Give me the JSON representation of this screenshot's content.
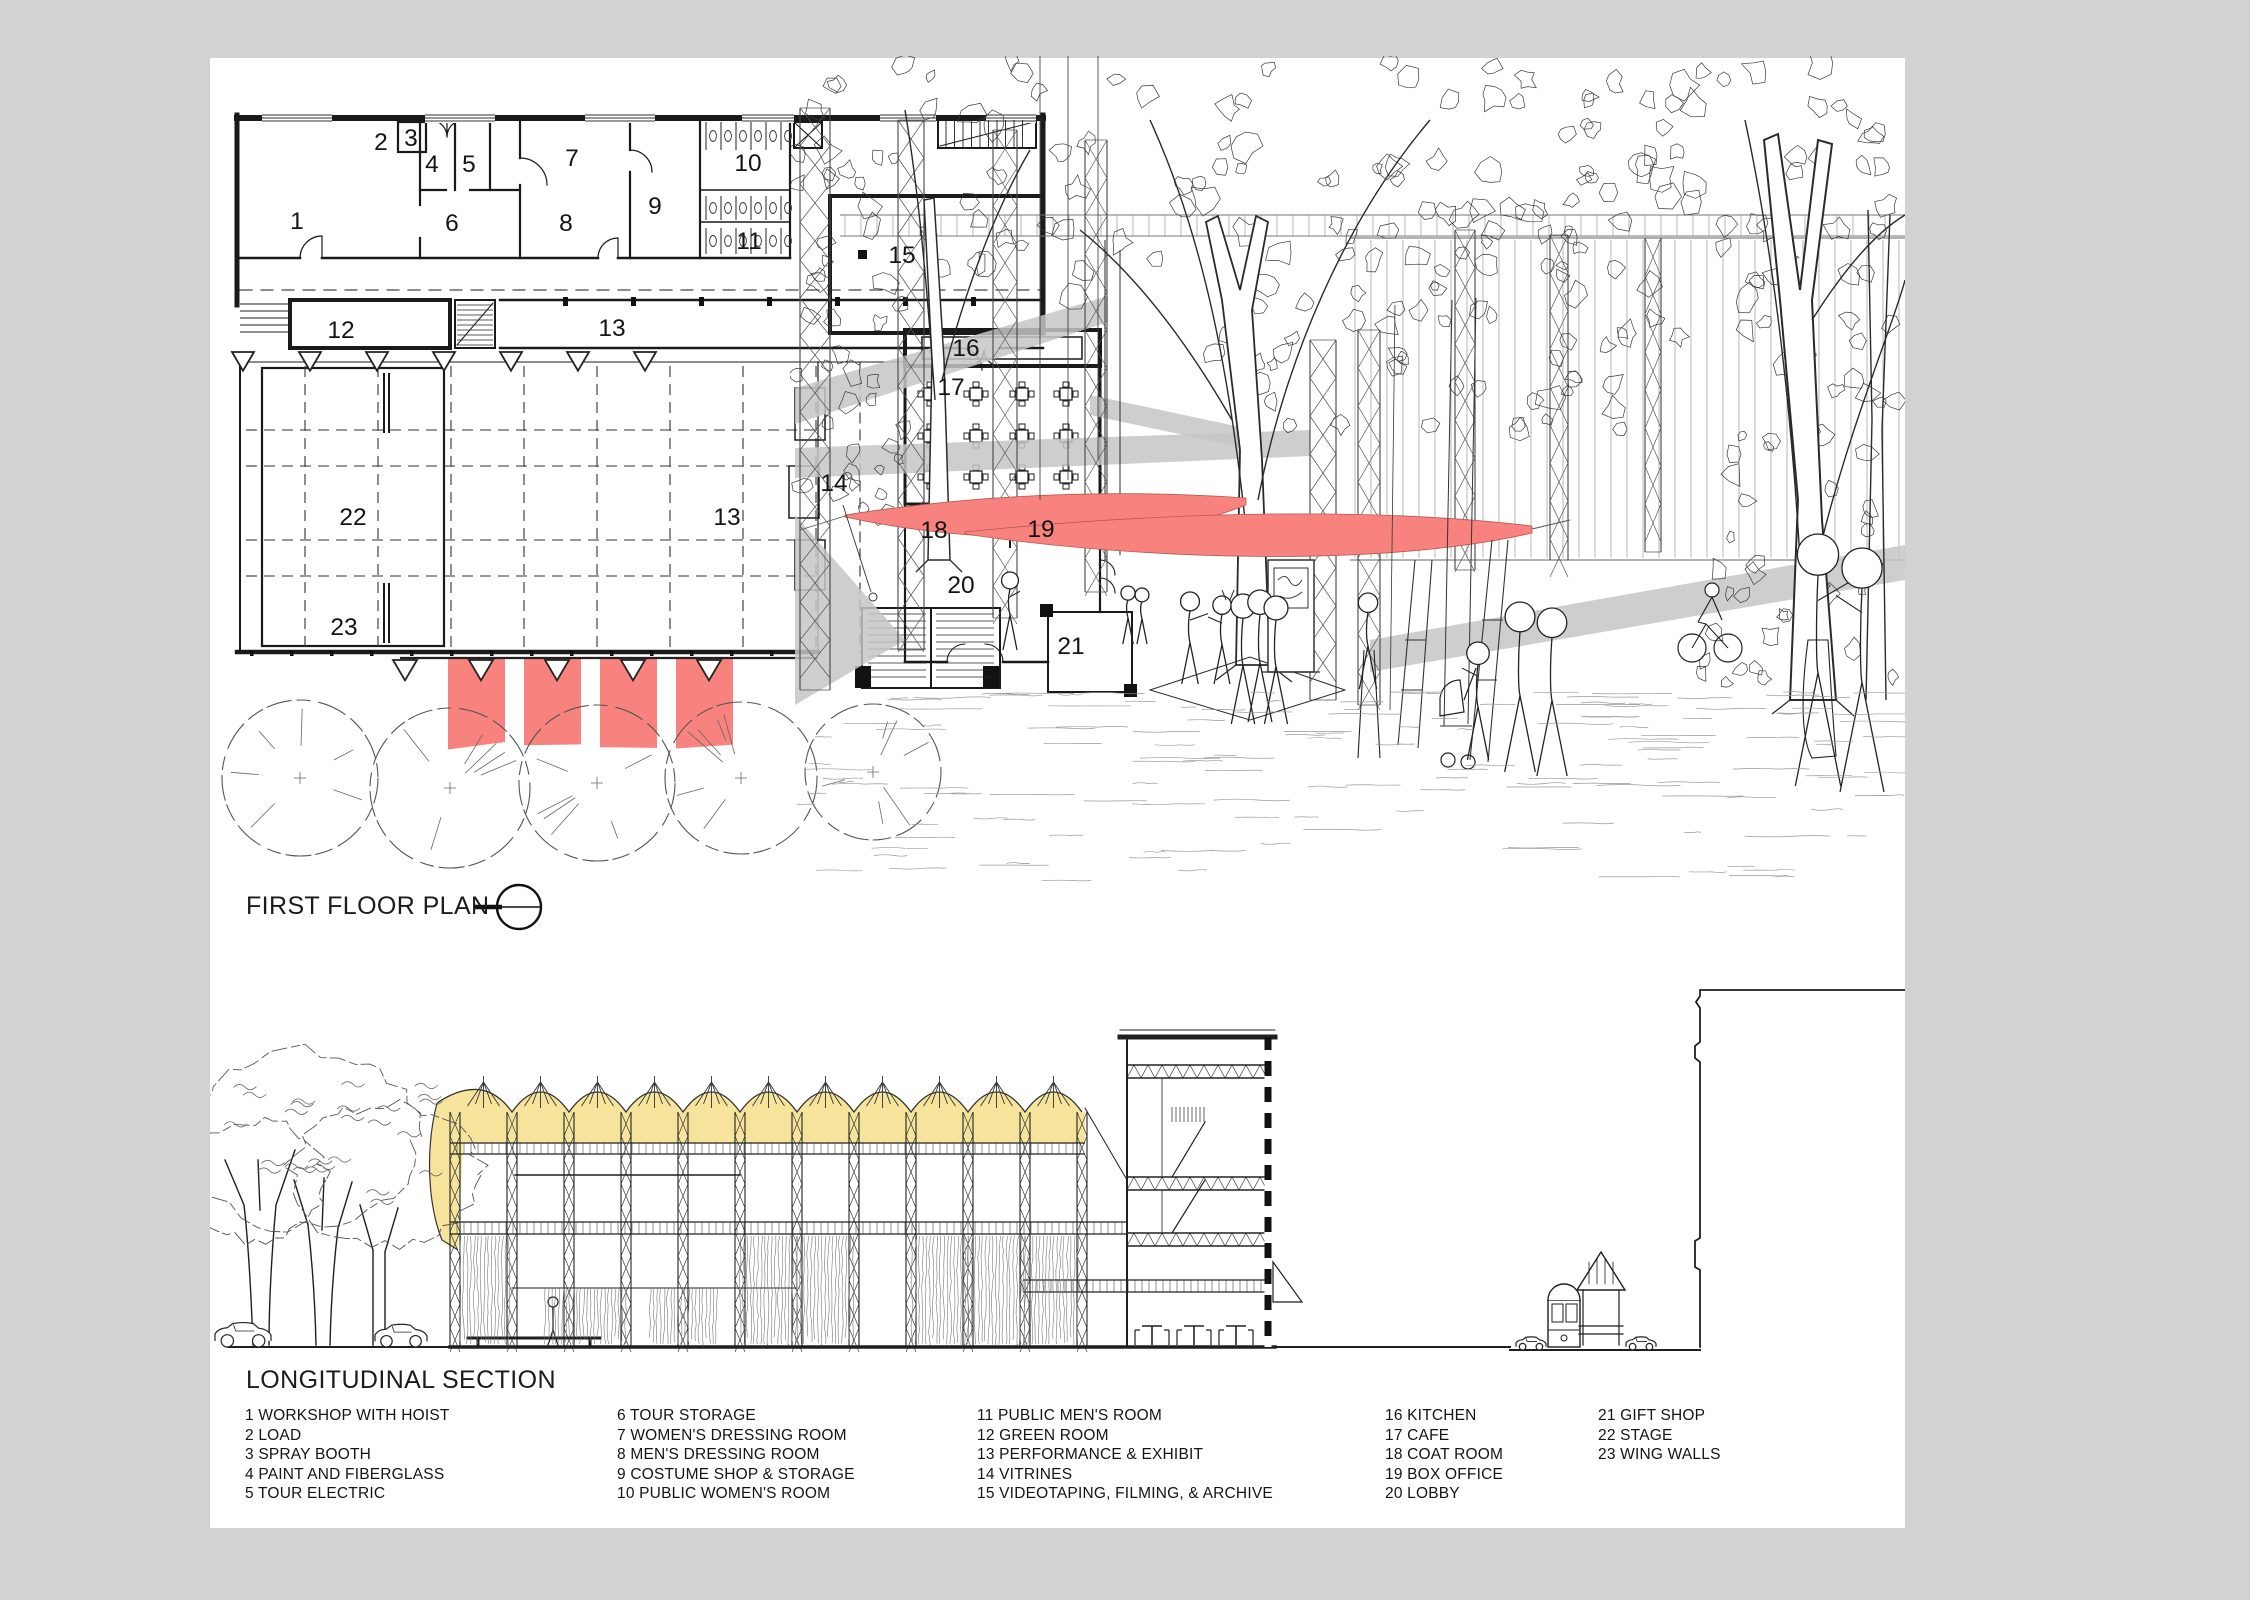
{
  "board": {
    "background": "#d2d2d2",
    "paper": "#ffffff"
  },
  "colors": {
    "accent_red": "#f8827e",
    "roof_yellow": "#f6e49c",
    "shadow_gray": "#c6c6c6",
    "line": "#222222"
  },
  "plan": {
    "title": "FIRST FLOOR PLAN",
    "room_numbers": [
      {
        "n": "1",
        "x": 297,
        "y": 229
      },
      {
        "n": "2",
        "x": 381,
        "y": 150
      },
      {
        "n": "3",
        "x": 411,
        "y": 146
      },
      {
        "n": "4",
        "x": 432,
        "y": 172
      },
      {
        "n": "5",
        "x": 469,
        "y": 172
      },
      {
        "n": "6",
        "x": 452,
        "y": 231
      },
      {
        "n": "7",
        "x": 572,
        "y": 166
      },
      {
        "n": "8",
        "x": 566,
        "y": 231
      },
      {
        "n": "9",
        "x": 655,
        "y": 214
      },
      {
        "n": "10",
        "x": 748,
        "y": 171
      },
      {
        "n": "11",
        "x": 749,
        "y": 249
      },
      {
        "n": "12",
        "x": 341,
        "y": 338
      },
      {
        "n": "13",
        "x": 612,
        "y": 336
      },
      {
        "n": "13",
        "x": 727,
        "y": 525
      },
      {
        "n": "14",
        "x": 834,
        "y": 491
      },
      {
        "n": "15",
        "x": 902,
        "y": 263
      },
      {
        "n": "16",
        "x": 966,
        "y": 356
      },
      {
        "n": "17",
        "x": 951,
        "y": 395
      },
      {
        "n": "18",
        "x": 934,
        "y": 538
      },
      {
        "n": "19",
        "x": 1041,
        "y": 537
      },
      {
        "n": "20",
        "x": 961,
        "y": 593
      },
      {
        "n": "21",
        "x": 1071,
        "y": 654
      },
      {
        "n": "22",
        "x": 353,
        "y": 525
      },
      {
        "n": "23",
        "x": 344,
        "y": 635
      }
    ]
  },
  "section": {
    "title": "LONGITUDINAL SECTION"
  },
  "legend": {
    "columns": [
      {
        "items": [
          "1 WORKSHOP WITH HOIST",
          "2 LOAD",
          "3 SPRAY BOOTH",
          "4 PAINT AND FIBERGLASS",
          "5 TOUR ELECTRIC"
        ]
      },
      {
        "items": [
          "6 TOUR STORAGE",
          "7 WOMEN'S DRESSING ROOM",
          "8 MEN'S DRESSING ROOM",
          "9 COSTUME SHOP & STORAGE",
          "10 PUBLIC WOMEN'S ROOM"
        ]
      },
      {
        "items": [
          "11 PUBLIC MEN'S ROOM",
          "12 GREEN ROOM",
          "13 PERFORMANCE & EXHIBIT",
          "14 VITRINES",
          "15 VIDEOTAPING, FILMING, & ARCHIVE"
        ]
      },
      {
        "items": [
          "16 KITCHEN",
          "17 CAFE",
          "18 COAT ROOM",
          "19 BOX OFFICE",
          "20 LOBBY"
        ]
      },
      {
        "items": [
          "21 GIFT SHOP",
          "22 STAGE",
          "23 WING WALLS"
        ]
      }
    ]
  }
}
